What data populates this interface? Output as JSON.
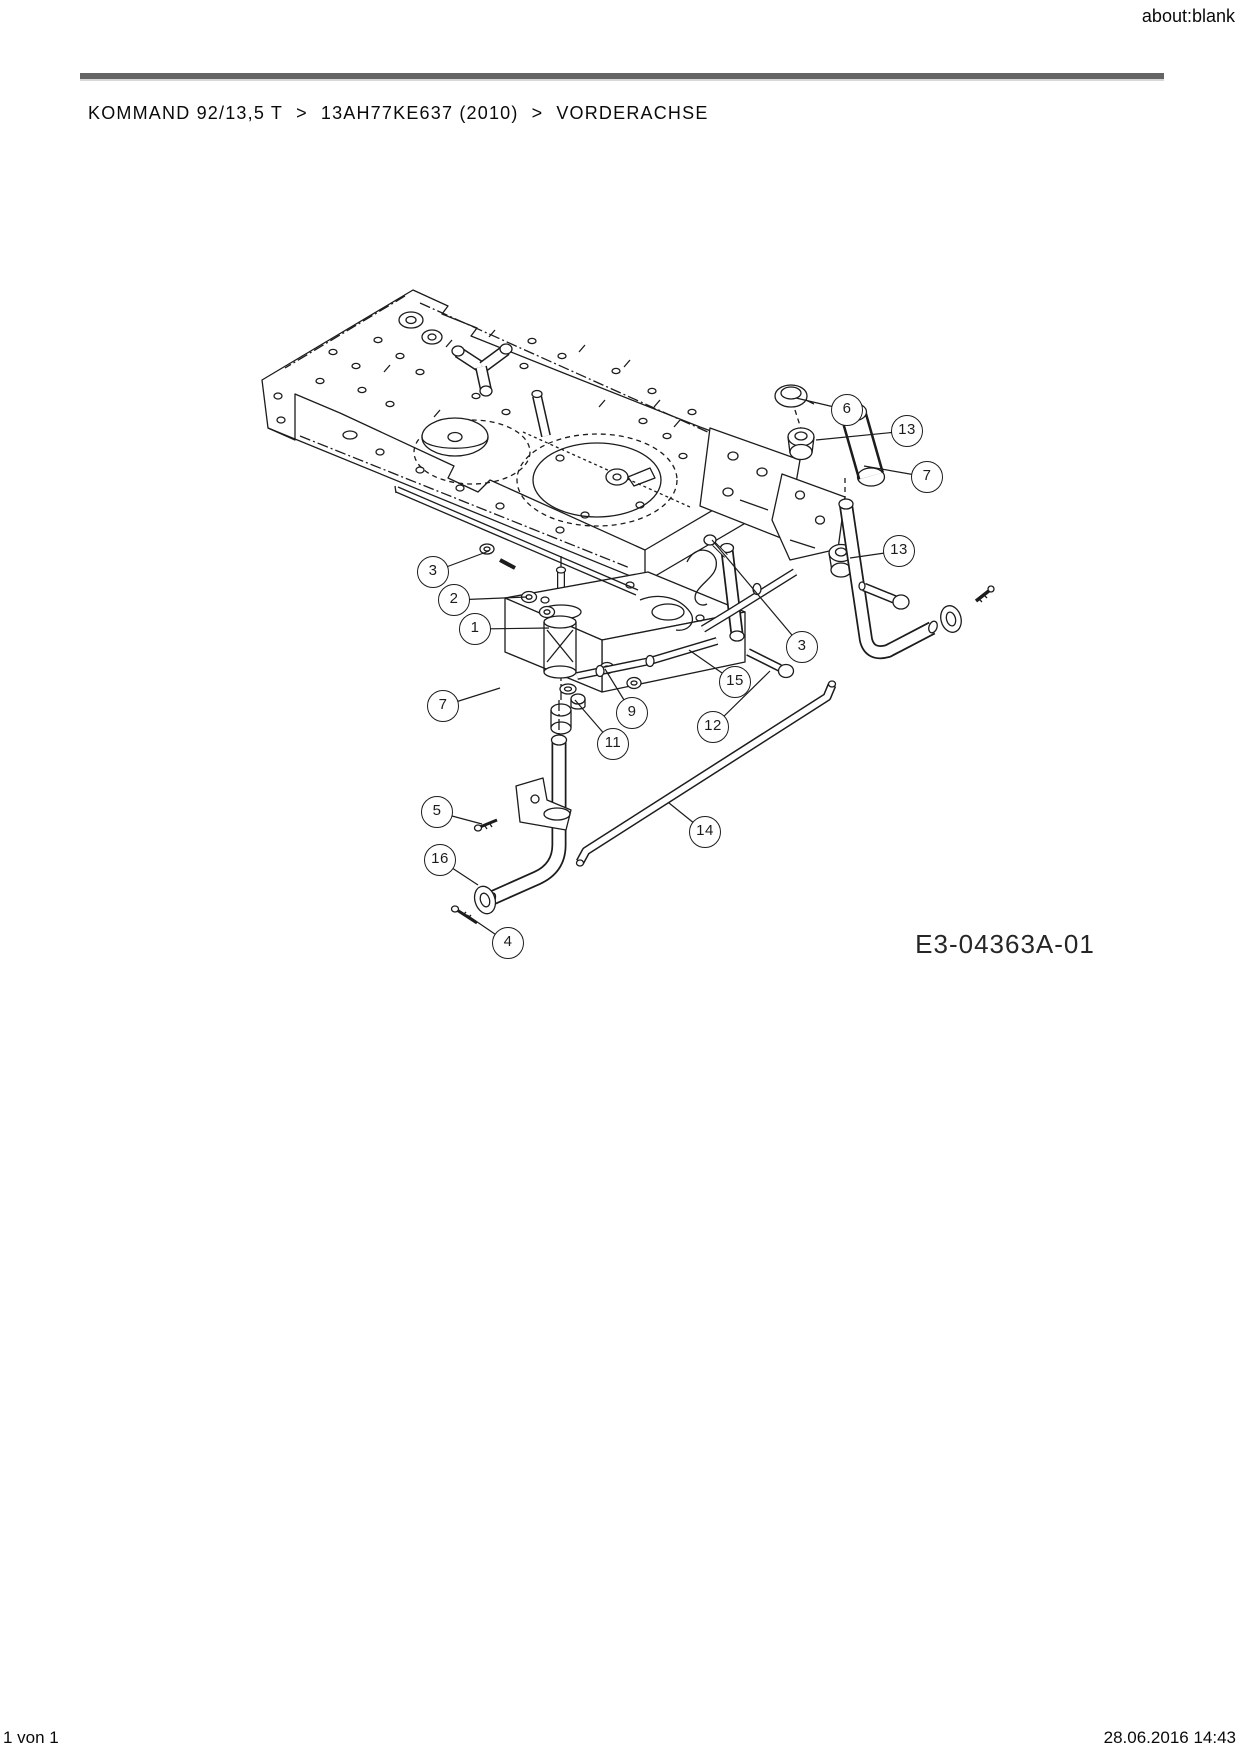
{
  "page": {
    "window_title": "about:blank",
    "breadcrumb": {
      "items": [
        "KOMMAND 92/13,5 T",
        "13AH77KE637 (2010)",
        "VORDERACHSE"
      ],
      "separator": ">"
    },
    "footer": {
      "left": "1 von 1",
      "right": "28.06.2016 14:43"
    }
  },
  "diagram": {
    "title": "VORDERACHSE (front axle) exploded parts drawing",
    "drawing_number": "E3-04363A-01",
    "colors": {
      "line": "#1c1c1c",
      "rule": "#646464"
    },
    "callouts": [
      {
        "label": "1",
        "cx": 475,
        "cy": 629,
        "tx": 549,
        "ty": 628
      },
      {
        "label": "2",
        "cx": 454,
        "cy": 600,
        "tx": 527,
        "ty": 597
      },
      {
        "label": "3",
        "cx": 433,
        "cy": 572,
        "tx": 489,
        "ty": 551
      },
      {
        "label": "3",
        "cx": 802,
        "cy": 647,
        "tx": 712,
        "ty": 540
      },
      {
        "label": "4",
        "cx": 508,
        "cy": 943,
        "tx": 467,
        "ty": 915
      },
      {
        "label": "5",
        "cx": 437,
        "cy": 812,
        "tx": 482,
        "ty": 824
      },
      {
        "label": "6",
        "cx": 847,
        "cy": 410,
        "tx": 796,
        "ty": 398
      },
      {
        "label": "7",
        "cx": 927,
        "cy": 477,
        "tx": 864,
        "ty": 466
      },
      {
        "label": "7",
        "cx": 443,
        "cy": 706,
        "tx": 500,
        "ty": 688
      },
      {
        "label": "9",
        "cx": 632,
        "cy": 713,
        "tx": 605,
        "ty": 669
      },
      {
        "label": "11",
        "cx": 613,
        "cy": 744,
        "tx": 575,
        "ty": 700
      },
      {
        "label": "12",
        "cx": 713,
        "cy": 727,
        "tx": 770,
        "ty": 671
      },
      {
        "label": "13",
        "cx": 907,
        "cy": 431,
        "tx": 816,
        "ty": 440
      },
      {
        "label": "13",
        "cx": 899,
        "cy": 551,
        "tx": 850,
        "ty": 558
      },
      {
        "label": "14",
        "cx": 705,
        "cy": 832,
        "tx": 669,
        "ty": 803
      },
      {
        "label": "15",
        "cx": 735,
        "cy": 682,
        "tx": 689,
        "ty": 650
      },
      {
        "label": "16",
        "cx": 440,
        "cy": 860,
        "tx": 478,
        "ty": 885
      }
    ]
  }
}
